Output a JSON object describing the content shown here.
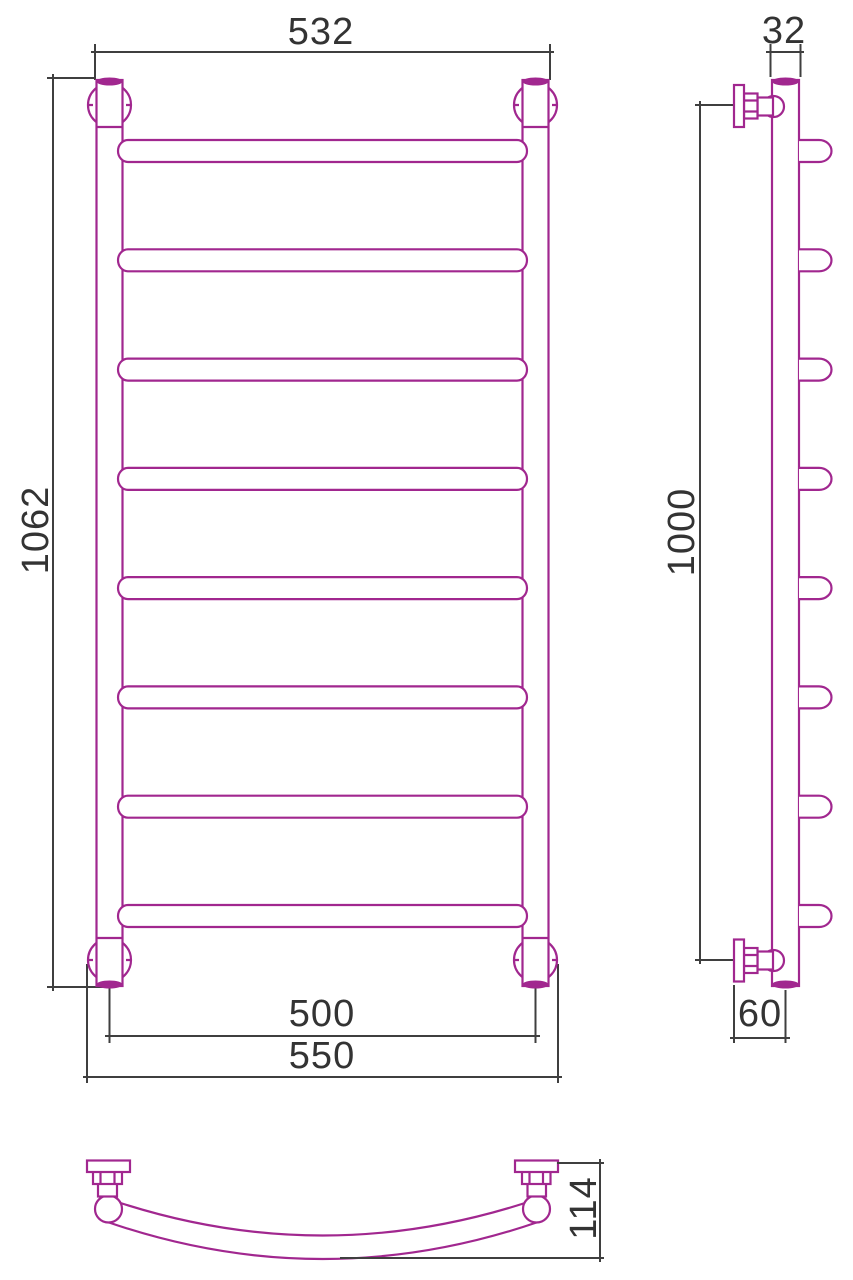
{
  "drawing": {
    "kind": "towel-rail-technical-drawing",
    "rung_count": 8
  },
  "colors": {
    "product_line": "#a1278f",
    "dimension_line": "#3f3f3f",
    "text": "#333333",
    "background": "#ffffff"
  },
  "views": {
    "front": {
      "dims": {
        "top_width": "532",
        "height": "1062",
        "bottom_center_width": "500",
        "bottom_overall_width": "550"
      }
    },
    "side": {
      "dims": {
        "tube_diameter": "32",
        "mount_height": "1000",
        "wall_offset": "60"
      }
    },
    "bottom": {
      "dims": {
        "depth": "114"
      }
    }
  }
}
